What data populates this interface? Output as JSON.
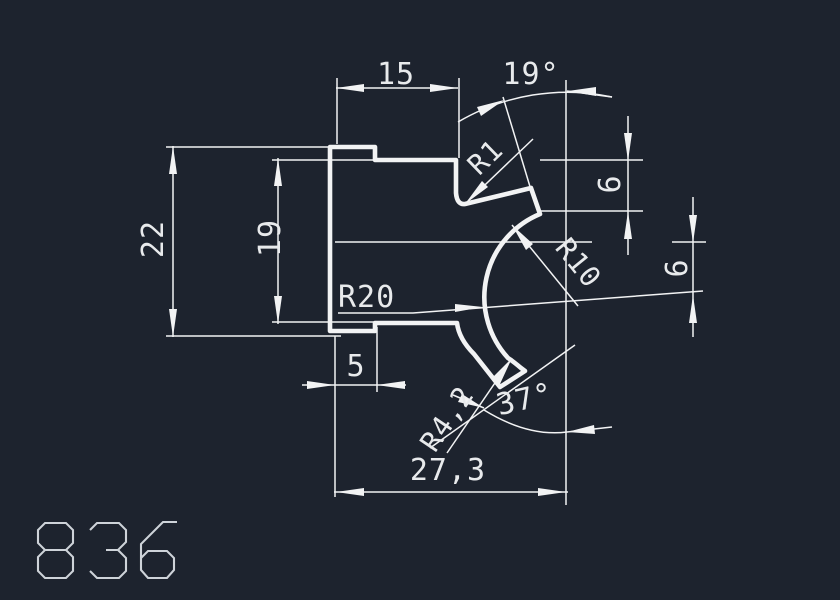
{
  "canvas": {
    "background": "#1d232e",
    "line_color": "#f2f3f4",
    "text_color": "#e8eaec",
    "digit_color": "#ced3d9"
  },
  "part": {
    "number": "836"
  },
  "dims": {
    "top_width": "15",
    "top_angle": "19°",
    "notch_radius": "R1",
    "upper_offset": "6",
    "lower_offset": "6",
    "left_height": "22",
    "inner_height": "19",
    "big_radius": "R20",
    "arc_radius": "R10",
    "step_width": "5",
    "tab_radius": "R4,2",
    "tab_angle": "37°",
    "total_width": "27,3"
  }
}
